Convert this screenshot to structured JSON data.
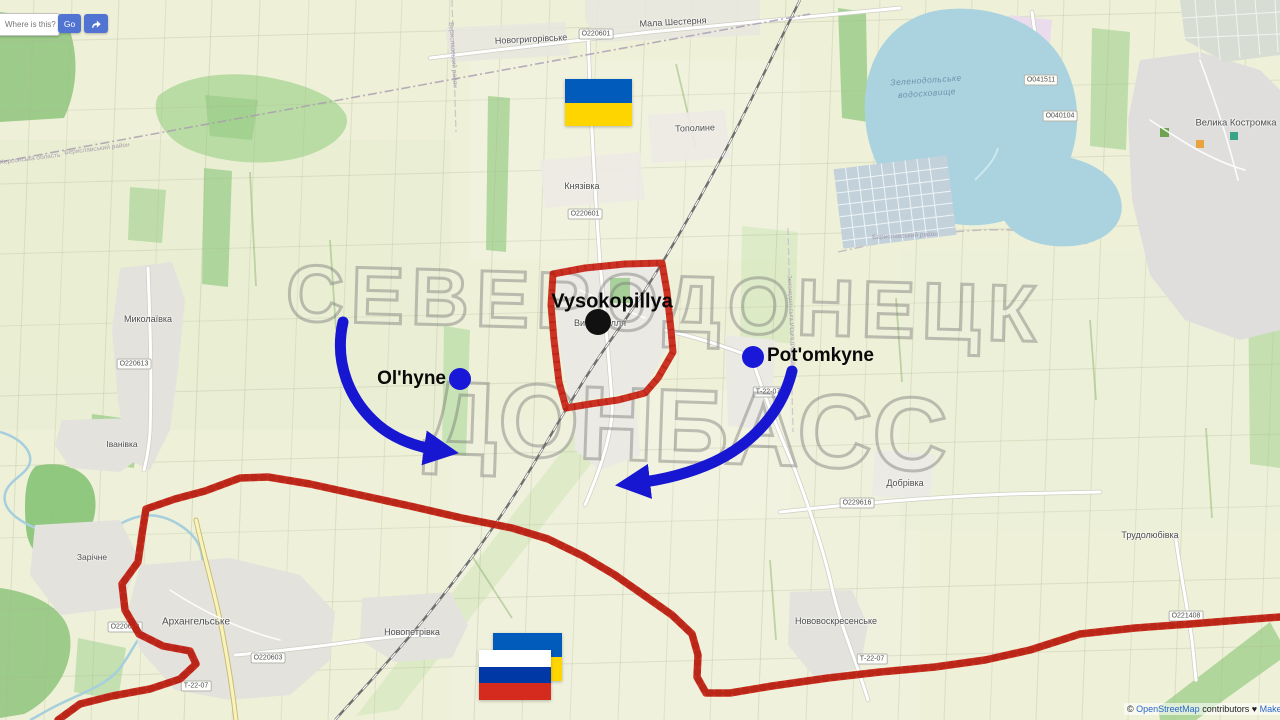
{
  "ui": {
    "search": {
      "placeholder": "Where is this?",
      "go": "Go"
    },
    "attribution": {
      "copyright": "© ",
      "osm_link": "OpenStreetMap",
      "contributors": " contributors ",
      "heart": "♥ ",
      "donate_link": "Make a Donation"
    }
  },
  "watermark": {
    "line1": "СЕВЕРОДОНЕЦК",
    "line2": "ДОНБАСС"
  },
  "annotations": {
    "colors": {
      "front_line": "#c9281a",
      "arrow": "#1717d1",
      "dot_blue": "#1a18d8",
      "dot_black": "#111111"
    },
    "towns": [
      {
        "name": "vysokopillya",
        "label": "Vysokopillya",
        "dot_color": "#111111",
        "dot_x": 598,
        "dot_y": 322,
        "dot_r": 13,
        "label_x": 612,
        "label_y": 302,
        "anchor": "middle",
        "font_size": 20
      },
      {
        "name": "olhyne",
        "label": "Ol'hyne",
        "dot_color": "#1a18d8",
        "dot_x": 460,
        "dot_y": 379,
        "dot_r": 11,
        "label_x": 446,
        "label_y": 379,
        "anchor": "end",
        "font_size": 19
      },
      {
        "name": "potomkyne",
        "label": "Pot'omkyne",
        "dot_color": "#1a18d8",
        "dot_x": 753,
        "dot_y": 357,
        "dot_r": 11,
        "label_x": 767,
        "label_y": 356,
        "anchor": "start",
        "font_size": 19
      }
    ]
  },
  "flags": {
    "ukraine_top": {
      "stripes": [
        "#005bbb",
        "#ffd500"
      ]
    },
    "ukraine_bottom": {
      "stripes": [
        "#005bbb",
        "#ffd500"
      ]
    },
    "russia_bottom": {
      "stripes": [
        "#ffffff",
        "#0039a6",
        "#d52b1e"
      ]
    }
  },
  "map_labels": [
    {
      "text": "Новогригорівське",
      "x": 531,
      "y": 39,
      "size": 9,
      "rot": -3
    },
    {
      "text": "Мала Шестерня",
      "x": 673,
      "y": 22,
      "size": 9,
      "rot": -3
    },
    {
      "text": "Тополине",
      "x": 695,
      "y": 128,
      "size": 9,
      "rot": -2
    },
    {
      "text": "Князівка",
      "x": 582,
      "y": 186,
      "size": 9,
      "rot": 0
    },
    {
      "text": "Миколаївка",
      "x": 148,
      "y": 319,
      "size": 9,
      "rot": 0
    },
    {
      "text": "Іванівка",
      "x": 122,
      "y": 444,
      "size": 8.5,
      "rot": 0
    },
    {
      "text": "Зарічне",
      "x": 92,
      "y": 557,
      "size": 8.5,
      "rot": 0
    },
    {
      "text": "Архангельське",
      "x": 196,
      "y": 622,
      "size": 10,
      "rot": 0
    },
    {
      "text": "Новопетрівка",
      "x": 412,
      "y": 632,
      "size": 9,
      "rot": 0
    },
    {
      "text": "Нововоскресенське",
      "x": 836,
      "y": 621,
      "size": 9,
      "rot": 0
    },
    {
      "text": "Добрівка",
      "x": 905,
      "y": 483,
      "size": 9,
      "rot": 0
    },
    {
      "text": "Трудолюбівка",
      "x": 1150,
      "y": 535,
      "size": 9,
      "rot": 0
    },
    {
      "text": "Велика Костромка",
      "x": 1236,
      "y": 123,
      "size": 9.5,
      "rot": 0
    },
    {
      "text": "Високопілля",
      "x": 600,
      "y": 323,
      "size": 9,
      "rot": 0
    }
  ],
  "road_badges": [
    {
      "text": "О220601",
      "x": 596,
      "y": 34
    },
    {
      "text": "О220601",
      "x": 585,
      "y": 214
    },
    {
      "text": "О220613",
      "x": 134,
      "y": 364
    },
    {
      "text": "О220613",
      "x": 125,
      "y": 627
    },
    {
      "text": "О220603",
      "x": 268,
      "y": 658
    },
    {
      "text": "Т-22-07",
      "x": 196,
      "y": 686
    },
    {
      "text": "Т-22-07",
      "x": 768,
      "y": 392
    },
    {
      "text": "Т-22-07",
      "x": 872,
      "y": 659
    },
    {
      "text": "О229616",
      "x": 857,
      "y": 503
    },
    {
      "text": "О221408",
      "x": 1186,
      "y": 616
    },
    {
      "text": "О041511",
      "x": 1041,
      "y": 80
    },
    {
      "text": "О040104",
      "x": 1060,
      "y": 116
    }
  ],
  "boundary_labels": [
    {
      "text": "Херсонська область",
      "x": 30,
      "y": 159,
      "rot": -7,
      "size": 6.5
    },
    {
      "text": "Бериславський район",
      "x": 97,
      "y": 149,
      "rot": -7,
      "size": 6.5
    },
    {
      "text": "Бериславський район",
      "x": 905,
      "y": 236,
      "rot": -3,
      "size": 6.5
    },
    {
      "text": "Бериславський район",
      "x": 453,
      "y": 55,
      "rot": 86,
      "size": 6.5
    },
    {
      "text": "Зеленодольська міська громада",
      "x": 791,
      "y": 320,
      "rot": 87,
      "size": 6
    }
  ],
  "water_labels": [
    {
      "text": "Зеленодольське",
      "x": 926,
      "y": 80,
      "size": 8.5,
      "rot": -4
    },
    {
      "text": "водосховище",
      "x": 927,
      "y": 93,
      "size": 8.5,
      "rot": -4
    }
  ]
}
